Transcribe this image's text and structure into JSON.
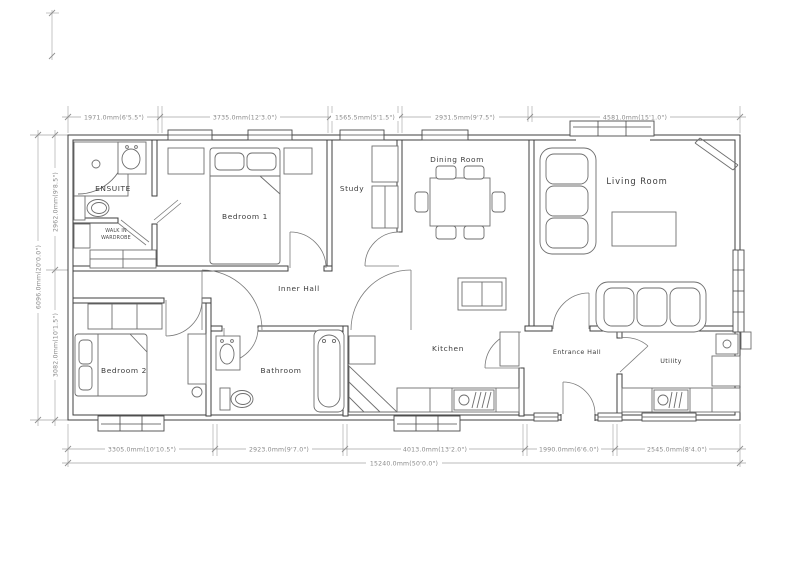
{
  "plan": {
    "rooms": {
      "ensuite": "ENSUITE",
      "wardrobe1": "WALK IN",
      "wardrobe2": "WARDROBE",
      "bedroom1": "Bedroom 1",
      "study": "Study",
      "dining": "Dining Room",
      "living": "Living Room",
      "inner_hall": "Inner Hall",
      "bedroom2": "Bedroom 2",
      "bathroom": "Bathroom",
      "kitchen": "Kitchen",
      "entrance": "Entrance Hall",
      "utility": "Utility"
    },
    "dims": {
      "top": [
        "1971.0mm(6'5.5\")",
        "3735.0mm(12'3.0\")",
        "1565.5mm(5'1.5\")",
        "2931.5mm(9'7.5\")",
        "4581.0mm(15'1.0\")"
      ],
      "bottom": [
        "3305.0mm(10'10.5\")",
        "2923.0mm(9'7.0\")",
        "4013.0mm(13'2.0\")",
        "1990.0mm(6'6.0\")",
        "2545.0mm(8'4.0\")"
      ],
      "bottom_total": "15240.0mm(50'0.0\")",
      "left_total": "6096.0mm(20'0.0\")",
      "left_top": "2962.0mm(9'8.5\")",
      "left_bottom": "3082.0mm(10'1.5\")"
    },
    "colors": {
      "background": "#ffffff",
      "wall_line": "#3f3f3f",
      "furniture_line": "#6e6e6e",
      "dimension_line": "#a5a5a5",
      "dimension_text": "#8a8a8a",
      "label_text": "#3c3c3c"
    }
  }
}
